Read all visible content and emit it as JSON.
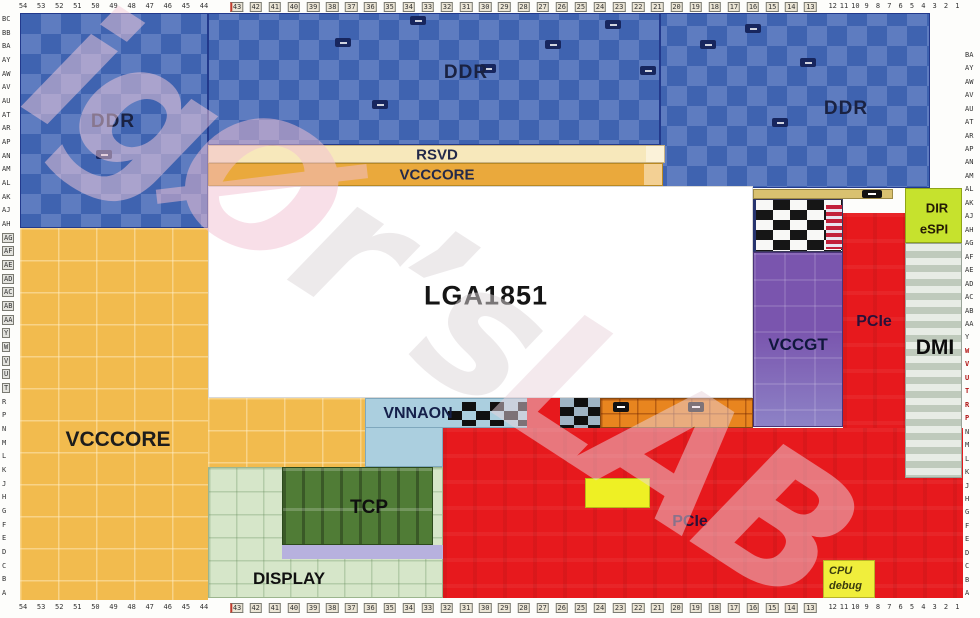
{
  "regions": {
    "ddr": "DDR",
    "rsvd": "RSVD",
    "vcccore": "VCCCORE",
    "socket": "LGA1851",
    "vnnaon": "VNNAON",
    "vccgt": "VCCGT",
    "pcie": "PCIe",
    "dmi": "DMI",
    "dir": "DIR",
    "espi": "eSPI",
    "tcp": "TCP",
    "display": "DISPLAY",
    "cpu_debug_line1": "CPU",
    "cpu_debug_line2": "debug"
  },
  "colors": {
    "ddr_base": "#3f63b0",
    "ddr_light": "#5e7cc0",
    "orange": "#f2bb4e",
    "orange_bar": "#eaa93c",
    "cream": "#f7e8bb",
    "lime": "#c6e22d",
    "red": "#e7191d",
    "purple": "#7a55ae",
    "purple_light": "#8d82c6",
    "dmi_bg": "#cfd8cb",
    "tcp_dark": "#507c36",
    "display_bg": "#d6e6c9",
    "lavender": "#b7b1de",
    "vnnaon_bg": "#abcfdf",
    "yellow": "#eef024",
    "debug_yellow": "#f0ee3c",
    "tan": "#d9c170",
    "orange_pins": "#e8851f"
  },
  "watermark": {
    "segments": [
      {
        "text": "ig",
        "color": "#f5cbdb"
      },
      {
        "text": "Ø",
        "color": "#f3c0d3"
      },
      {
        "text": "r’s",
        "color": "#dcd6d9"
      },
      {
        "text": "LAB",
        "color": "#ead4dd"
      }
    ]
  },
  "axes": {
    "top_numbers": [
      "54",
      "53",
      "52",
      "51",
      "50",
      "49",
      "48",
      "47",
      "46",
      "45",
      "44",
      "43",
      "42",
      "41",
      "40",
      "39",
      "38",
      "37",
      "36",
      "35",
      "34",
      "33",
      "32",
      "31",
      "30",
      "29",
      "28",
      "27",
      "26",
      "25",
      "24",
      "23",
      "22",
      "21",
      "20",
      "19",
      "18",
      "17",
      "16",
      "15",
      "14",
      "13",
      "12",
      "11",
      "10",
      "9",
      "8",
      "7",
      "6",
      "5",
      "4",
      "3",
      "2",
      "1"
    ],
    "bottom_numbers": [
      "54",
      "53",
      "52",
      "51",
      "50",
      "49",
      "48",
      "47",
      "46",
      "45",
      "44",
      "43",
      "42",
      "41",
      "40",
      "39",
      "38",
      "37",
      "36",
      "35",
      "34",
      "33",
      "32",
      "31",
      "30",
      "29",
      "28",
      "27",
      "26",
      "25",
      "24",
      "23",
      "22",
      "21",
      "20",
      "19",
      "18",
      "17",
      "16",
      "15",
      "14",
      "13",
      "12",
      "11",
      "10",
      "9",
      "8",
      "7",
      "6",
      "5",
      "4",
      "3",
      "2",
      "1"
    ],
    "left_rows": [
      "BC",
      "BB",
      "BA",
      "AY",
      "AW",
      "AV",
      "AU",
      "AT",
      "AR",
      "AP",
      "AN",
      "AM",
      "AL",
      "AK",
      "AJ",
      "AH",
      "AG",
      "AF",
      "AE",
      "AD",
      "AC",
      "AB",
      "AA",
      "Y",
      "W",
      "V",
      "U",
      "T",
      "R",
      "P",
      "N",
      "M",
      "L",
      "K",
      "J",
      "H",
      "G",
      "F",
      "E",
      "D",
      "C",
      "B",
      "A"
    ],
    "right_rows": [
      "BA",
      "AY",
      "AW",
      "AV",
      "AU",
      "AT",
      "AR",
      "AP",
      "AN",
      "AM",
      "AL",
      "AK",
      "AJ",
      "AH",
      "AG",
      "AF",
      "AE",
      "AD",
      "AC",
      "AB",
      "AA",
      "Y",
      "W",
      "V",
      "U",
      "T",
      "R",
      "P",
      "N",
      "M",
      "L",
      "K",
      "J",
      "H",
      "G",
      "F",
      "E",
      "D",
      "C",
      "B",
      "A"
    ],
    "top_boxed": [
      11,
      42
    ],
    "bottom_boxed": [
      11,
      42
    ],
    "left_boxed": [
      16,
      28
    ],
    "right_red": [
      22,
      28
    ]
  }
}
